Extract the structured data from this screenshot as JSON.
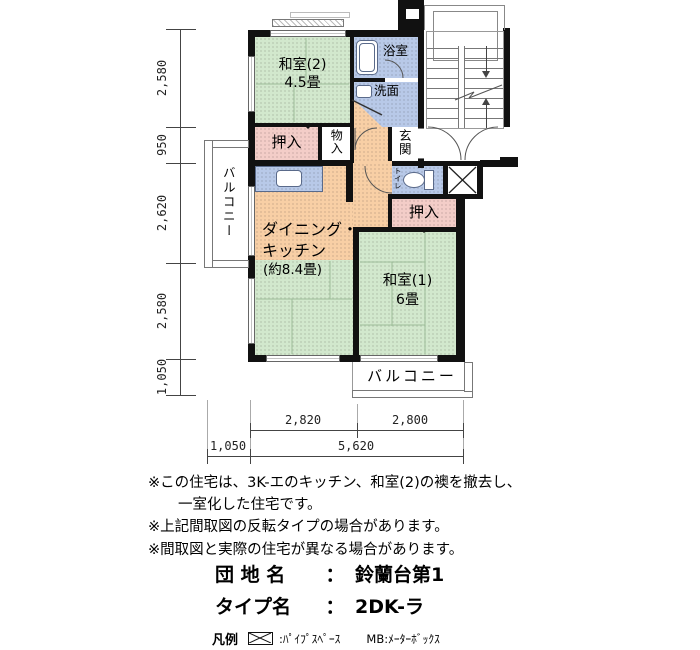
{
  "plan": {
    "rooms": {
      "washitsu2_name": "和室(2)",
      "washitsu2_size": "4.5畳",
      "bath": "浴室",
      "washroom": "洗面",
      "closet_top": "押入",
      "storage": "物入",
      "entrance": "玄関",
      "toilet": "トイレ",
      "closet_right": "押入",
      "dk_line1": "ダイニング・",
      "dk_line2": "キッチン",
      "dk_size": "(約8.4畳)",
      "washitsu1_name": "和室(1)",
      "washitsu1_size": "6畳",
      "balcony_left": "バルコニー",
      "balcony_bottom": "バルコニー"
    },
    "dims_left": [
      "2,580",
      "950",
      "2,620",
      "2,580",
      "1,050"
    ],
    "dims_bottom_row1": [
      "2,820",
      "2,800"
    ],
    "dims_bottom_row2": [
      "1,050",
      "5,620"
    ]
  },
  "notes": {
    "line1": "※この住宅は、3K-エのキッチン、和室(2)の襖を撤去し、",
    "line2": "一室化した住宅です。",
    "line3": "※上記間取図の反転タイプの場合があります。",
    "line4": "※間取図と実際の住宅が異なる場合があります。"
  },
  "info": {
    "estate_label": "団 地 名",
    "separator": "：",
    "estate_value": "鈴蘭台第1",
    "type_label": "タイプ名",
    "type_value": "2DK-ラ"
  },
  "legend": {
    "title": "凡例",
    "pipe_space": ":ﾊﾟｲﾌﾟｽﾍﾟｰｽ",
    "meter_box": "MB:ﾒｰﾀｰﾎﾞｯｸｽ"
  },
  "colors": {
    "tatami_green": "#d2e8cd",
    "water_blue": "#b8c9e8",
    "dk_orange": "#f8cfa5",
    "closet_pink": "#f3cdc8",
    "wall_black": "#111111"
  }
}
